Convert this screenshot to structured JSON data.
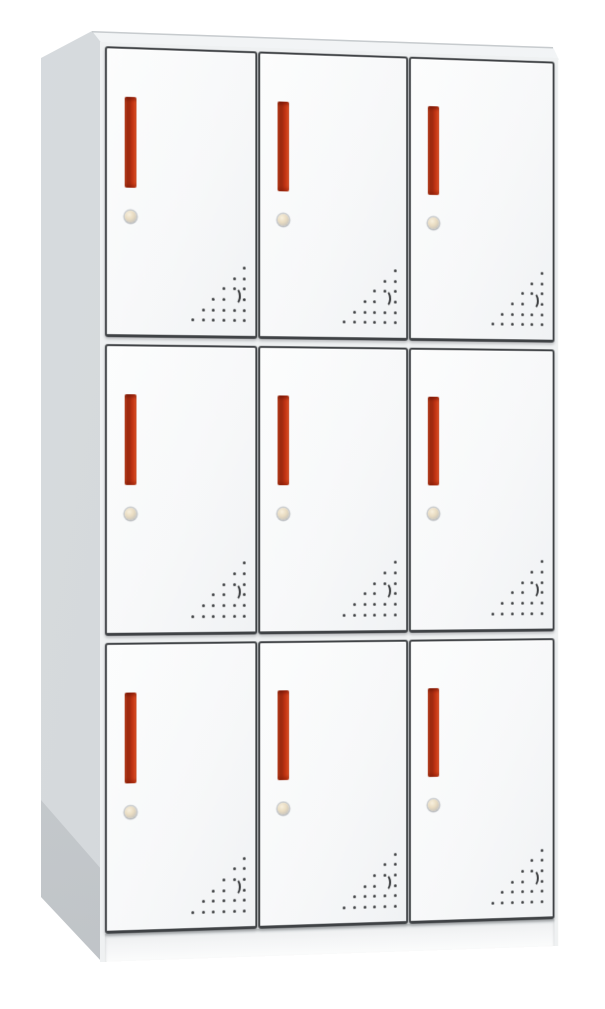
{
  "scene": {
    "kind": "product-photo",
    "subject": "nine-door metal locker cabinet",
    "background": "plain white"
  },
  "cabinet": {
    "rows": 3,
    "columns": 3,
    "door_count": 9,
    "visible_panels": [
      "front",
      "left-side",
      "top"
    ],
    "door_parts": {
      "handle": "vertical-recessed-red-handle",
      "lock": "round-cam-lock",
      "vent": "triangular-dot-vent-bottom-right"
    },
    "colors": {
      "background": "#ffffff",
      "body": "#eff1f2",
      "door_face": "#f7f8f9",
      "door_outline": "#3f4245",
      "side_panel": "#d3d7da",
      "handle_red": "#b93011",
      "handle_highlight": "#ee5a2b",
      "handle_shadow": "#9e2a0f",
      "lock_brass": "#e9dcc2",
      "vent_dot": "#3c3e40"
    },
    "vent_pattern_legend": {
      "0": "empty",
      "1": "hole",
      "2": "crescent-hole"
    },
    "vent_pattern": [
      [
        0,
        0,
        0,
        0,
        0,
        1
      ],
      [
        0,
        0,
        0,
        0,
        1,
        1
      ],
      [
        0,
        0,
        0,
        1,
        1,
        1
      ],
      [
        0,
        0,
        1,
        1,
        2,
        1
      ],
      [
        0,
        1,
        1,
        1,
        1,
        1
      ],
      [
        1,
        1,
        1,
        1,
        1,
        1
      ]
    ]
  }
}
